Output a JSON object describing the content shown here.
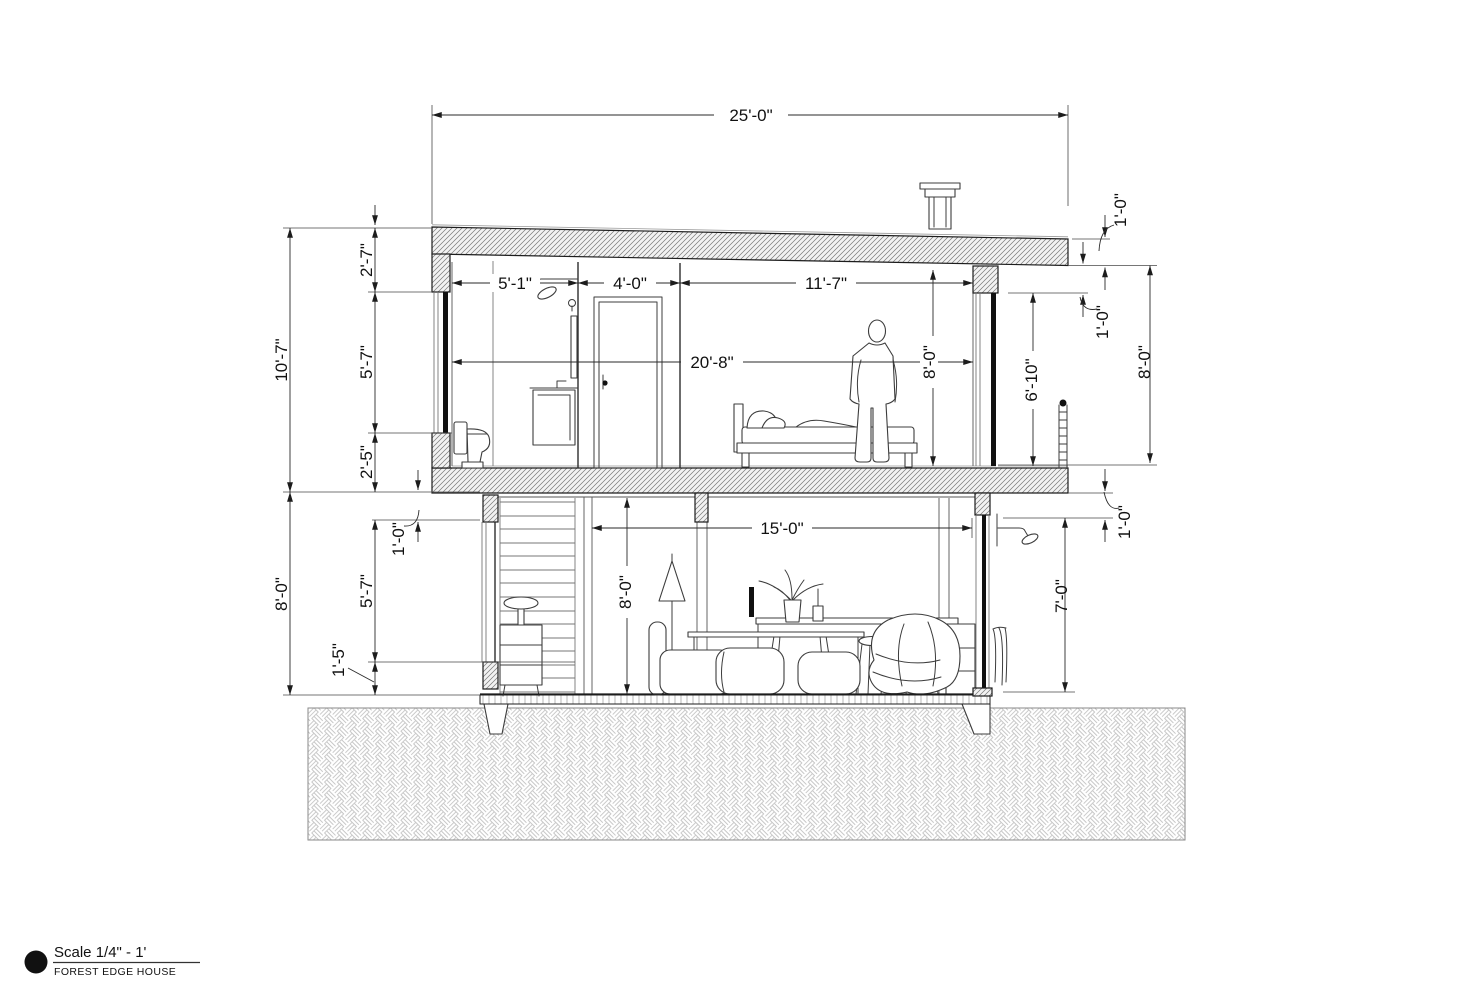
{
  "title_block": {
    "scale_label": "Scale 1/4\" - 1'",
    "project_name": "FOREST EDGE HOUSE"
  },
  "dimensions": {
    "overall_width": "25'-0\"",
    "upper_total_height": "10'-7\"",
    "upper_parapet": "2'-7\"",
    "upper_window_height": "5'-7\"",
    "upper_sill": "2'-5\"",
    "lower_total_height": "8'-0\"",
    "lower_head_drop": "1'-0\"",
    "lower_window_height": "5'-7\"",
    "lower_sill": "1'-5\"",
    "bath_width": "5'-1\"",
    "closet_width": "4'-0\"",
    "bedroom_width": "11'-7\"",
    "upper_interior_width": "20'-8\"",
    "upper_interior_height": "8'-0\"",
    "right_window_height": "6'-10\"",
    "roof_edge_thickness": "1'-0\"",
    "roof_to_window_head": "1'-0\"",
    "right_exterior_height": "8'-0\"",
    "floor_edge_thickness": "1'-0\"",
    "lower_interior_width": "15'-0\"",
    "lower_interior_height": "8'-0\"",
    "outdoor_shower_height": "7'-0\""
  }
}
